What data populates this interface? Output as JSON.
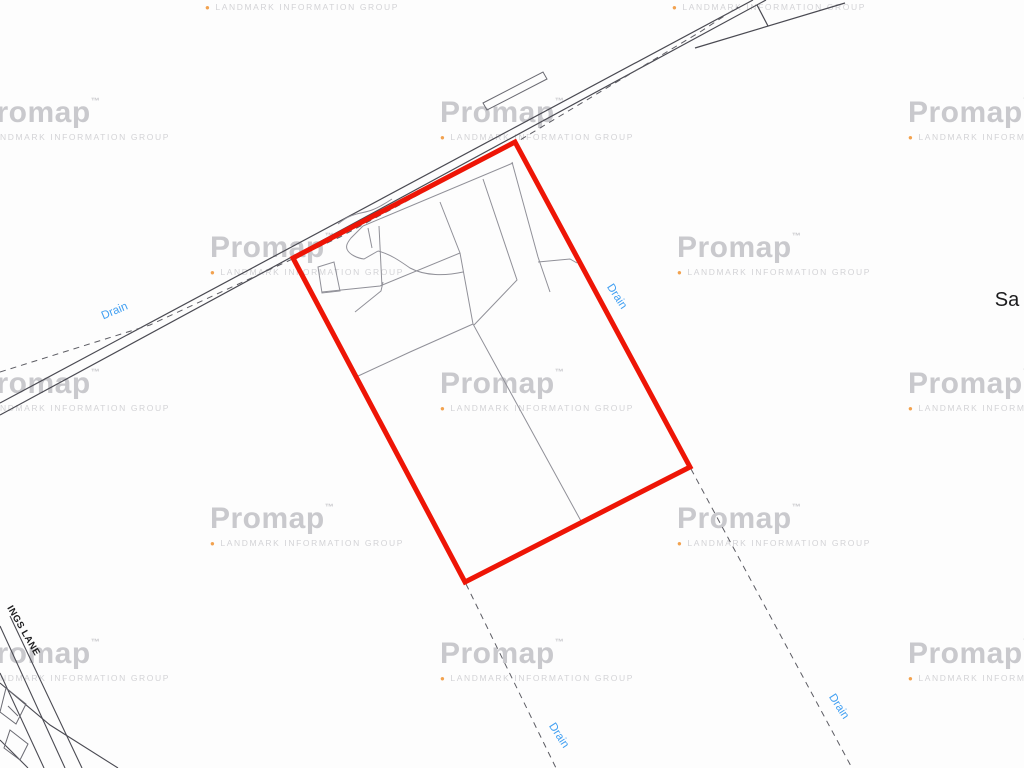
{
  "watermark": {
    "brand": "Promap",
    "trademark_mark": "™",
    "subtitle": "LANDMARK INFORMATION GROUP",
    "bullet": "●",
    "positions": [
      {
        "x": -24,
        "y": 97
      },
      {
        "x": 440,
        "y": 97
      },
      {
        "x": 908,
        "y": 97
      },
      {
        "x": 205,
        "y": -33
      },
      {
        "x": 672,
        "y": -33
      },
      {
        "x": 210,
        "y": 232
      },
      {
        "x": 677,
        "y": 232
      },
      {
        "x": -24,
        "y": 368
      },
      {
        "x": 440,
        "y": 368
      },
      {
        "x": 908,
        "y": 368
      },
      {
        "x": 210,
        "y": 503
      },
      {
        "x": 677,
        "y": 503
      },
      {
        "x": -24,
        "y": 638
      },
      {
        "x": 440,
        "y": 638
      },
      {
        "x": 908,
        "y": 638
      }
    ]
  },
  "map": {
    "labels": {
      "drains": [
        {
          "text": "Drain",
          "x": 115,
          "y": 312,
          "rotation": -23
        },
        {
          "text": "Drain",
          "x": 616,
          "y": 297,
          "rotation": 57
        },
        {
          "text": "Drain",
          "x": 558,
          "y": 736,
          "rotation": 57
        },
        {
          "text": "Drain",
          "x": 838,
          "y": 707,
          "rotation": 57
        }
      ],
      "road_name": {
        "text": "INGS LANE",
        "x": 23,
        "y": 631,
        "rotation": 60
      },
      "partial_place_name": {
        "text": "Sa",
        "x": 1007,
        "y": 300
      }
    },
    "colors": {
      "background": "#fdfdfd",
      "site_boundary": "#ee1506",
      "road_line": "#4a4a52",
      "building_line": "#6a6a72",
      "parcel_line": "#909098",
      "drain_line": "#5c5c63",
      "drain_label": "#42a0f2",
      "map_text": "#1c1c1e",
      "watermark_text": "#c9c9cd",
      "watermark_subtext": "#d3d3d6",
      "watermark_dot": "#f2a24f"
    }
  }
}
